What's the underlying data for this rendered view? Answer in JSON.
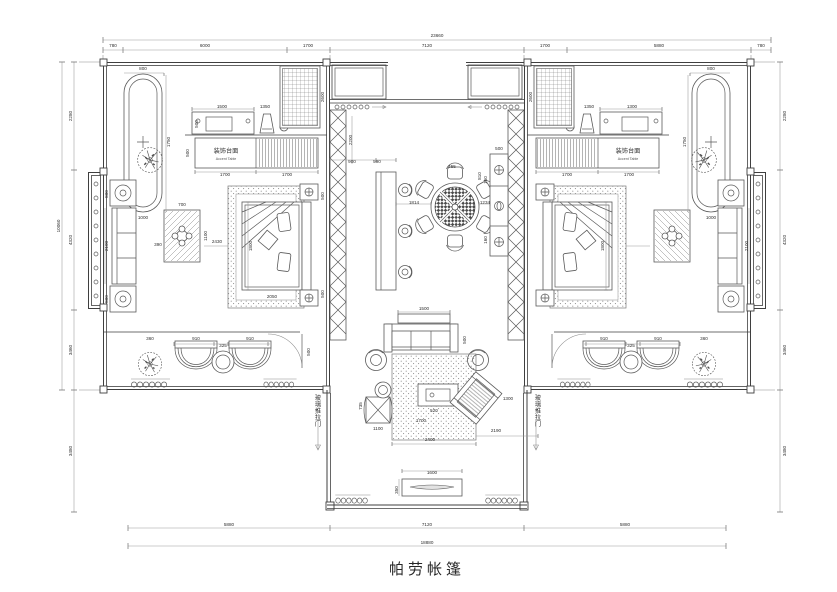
{
  "title": {
    "text": "帕劳帐篷"
  },
  "colors": {
    "line": "#3f3f3f",
    "furniture": "#5a5a5a",
    "dim": "#9a9a9a",
    "background": "#ffffff",
    "text": "#2f2f2f"
  },
  "rooms": {
    "accent_table_cn": "装饰台面",
    "accent_table_en": "Accent Table",
    "sliding_door_note": "玻璃推拉门"
  },
  "dimensions": {
    "top_total": "23660",
    "top_segments": [
      "780",
      "6000",
      "1700",
      "7120",
      "1700",
      "5880",
      "780"
    ],
    "bottom_segments": [
      "5880",
      "7120",
      "5880"
    ],
    "bottom_total": "18880",
    "left_segments": [
      "2280",
      "4320",
      "3460"
    ],
    "left_total": "10060",
    "left_lower": "3480",
    "right_segments": [
      "2280",
      "4320",
      "3460"
    ],
    "right_lower": "3480"
  },
  "annotations": {
    "labels": [
      {
        "t": "23660",
        "x": 437,
        "y": 37
      },
      {
        "t": "780",
        "x": 113,
        "y": 47
      },
      {
        "t": "6000",
        "x": 205,
        "y": 47
      },
      {
        "t": "1700",
        "x": 308,
        "y": 47
      },
      {
        "t": "7120",
        "x": 427,
        "y": 47
      },
      {
        "t": "1700",
        "x": 545,
        "y": 47
      },
      {
        "t": "5880",
        "x": 659,
        "y": 47
      },
      {
        "t": "780",
        "x": 761,
        "y": 47
      },
      {
        "t": "5880",
        "x": 229,
        "y": 526
      },
      {
        "t": "7120",
        "x": 427,
        "y": 526
      },
      {
        "t": "5880",
        "x": 625,
        "y": 526
      },
      {
        "t": "18880",
        "x": 427,
        "y": 544
      },
      {
        "t": "2280",
        "x": 72,
        "y": 116,
        "r": -90
      },
      {
        "t": "4320",
        "x": 72,
        "y": 240,
        "r": -90
      },
      {
        "t": "3460",
        "x": 72,
        "y": 350,
        "r": -90
      },
      {
        "t": "10060",
        "x": 60,
        "y": 226,
        "r": -90
      },
      {
        "t": "3480",
        "x": 72,
        "y": 451,
        "r": -90
      },
      {
        "t": "2280",
        "x": 786,
        "y": 116,
        "r": -90
      },
      {
        "t": "4320",
        "x": 786,
        "y": 240,
        "r": -90
      },
      {
        "t": "3460",
        "x": 786,
        "y": 350,
        "r": -90
      },
      {
        "t": "3480",
        "x": 786,
        "y": 451,
        "r": -90
      },
      {
        "t": "800",
        "x": 143,
        "y": 70
      },
      {
        "t": "1750",
        "x": 170,
        "y": 142,
        "r": -90
      },
      {
        "t": "1000",
        "x": 143,
        "y": 219
      },
      {
        "t": "1500",
        "x": 222,
        "y": 108
      },
      {
        "t": "500",
        "x": 198,
        "y": 124,
        "r": -90
      },
      {
        "t": "1350",
        "x": 265,
        "y": 108
      },
      {
        "t": "2600",
        "x": 324,
        "y": 97,
        "r": -90
      },
      {
        "t": "装饰台面",
        "x": 226,
        "y": 153,
        "c": "room"
      },
      {
        "t": "Accent Table",
        "x": 226,
        "y": 160,
        "c": "sub"
      },
      {
        "t": "1700",
        "x": 225,
        "y": 176
      },
      {
        "t": "1700",
        "x": 287,
        "y": 176
      },
      {
        "t": "500",
        "x": 189,
        "y": 153,
        "r": -90
      },
      {
        "t": "800",
        "x": 108,
        "y": 194,
        "r": -90
      },
      {
        "t": "2100",
        "x": 108,
        "y": 246,
        "r": -90
      },
      {
        "t": "800",
        "x": 108,
        "y": 299,
        "r": -90
      },
      {
        "t": "700",
        "x": 182,
        "y": 206
      },
      {
        "t": "1100",
        "x": 207,
        "y": 236,
        "r": -90
      },
      {
        "t": "390",
        "x": 158,
        "y": 246
      },
      {
        "t": "2430",
        "x": 217,
        "y": 243
      },
      {
        "t": "1800",
        "x": 252,
        "y": 246,
        "r": -90
      },
      {
        "t": "2050",
        "x": 272,
        "y": 298
      },
      {
        "t": "500",
        "x": 324,
        "y": 196,
        "r": -90
      },
      {
        "t": "500",
        "x": 324,
        "y": 294,
        "r": -90
      },
      {
        "t": "360",
        "x": 150,
        "y": 340
      },
      {
        "t": "910",
        "x": 196,
        "y": 340
      },
      {
        "t": "325",
        "x": 223,
        "y": 347
      },
      {
        "t": "910",
        "x": 250,
        "y": 340
      },
      {
        "t": "500",
        "x": 310,
        "y": 352,
        "r": -90
      },
      {
        "t": "玻璃推拉门",
        "x": 318,
        "y": 400,
        "s": 1,
        "c": "room"
      },
      {
        "t": "玻璃推拉门",
        "x": 538,
        "y": 400,
        "s": 1,
        "c": "room"
      },
      {
        "t": "900",
        "x": 352,
        "y": 163
      },
      {
        "t": "590",
        "x": 377,
        "y": 163
      },
      {
        "t": "2200",
        "x": 352,
        "y": 140,
        "r": -90
      },
      {
        "t": "1814",
        "x": 414,
        "y": 204
      },
      {
        "t": "455",
        "x": 452,
        "y": 168
      },
      {
        "t": "810",
        "x": 481,
        "y": 176,
        "r": -90
      },
      {
        "t": "1234",
        "x": 485,
        "y": 204
      },
      {
        "t": "500",
        "x": 499,
        "y": 150
      },
      {
        "t": "160",
        "x": 487,
        "y": 180,
        "r": -90
      },
      {
        "t": "160",
        "x": 487,
        "y": 240,
        "r": -90
      },
      {
        "t": "1500",
        "x": 424,
        "y": 310
      },
      {
        "t": "500",
        "x": 466,
        "y": 340,
        "r": -90
      },
      {
        "t": "735",
        "x": 362,
        "y": 406,
        "r": -90
      },
      {
        "t": "1100",
        "x": 378,
        "y": 430
      },
      {
        "t": "520",
        "x": 434,
        "y": 412
      },
      {
        "t": "1700",
        "x": 421,
        "y": 422
      },
      {
        "t": "2400",
        "x": 430,
        "y": 441
      },
      {
        "t": "2190",
        "x": 496,
        "y": 432
      },
      {
        "t": "1300",
        "x": 508,
        "y": 400
      },
      {
        "t": "1600",
        "x": 432,
        "y": 474
      },
      {
        "t": "350",
        "x": 398,
        "y": 490,
        "r": -90
      },
      {
        "t": "800",
        "x": 711,
        "y": 70
      },
      {
        "t": "1750",
        "x": 686,
        "y": 142,
        "r": -90
      },
      {
        "t": "1000",
        "x": 711,
        "y": 219
      },
      {
        "t": "1300",
        "x": 632,
        "y": 108
      },
      {
        "t": "1350",
        "x": 589,
        "y": 108
      },
      {
        "t": "2600",
        "x": 532,
        "y": 97,
        "r": -90
      },
      {
        "t": "装饰台面",
        "x": 628,
        "y": 153,
        "c": "room"
      },
      {
        "t": "Accent Table",
        "x": 628,
        "y": 160,
        "c": "sub"
      },
      {
        "t": "1700",
        "x": 629,
        "y": 176
      },
      {
        "t": "1700",
        "x": 567,
        "y": 176
      },
      {
        "t": "2100",
        "x": 748,
        "y": 246,
        "r": -90
      },
      {
        "t": "1800",
        "x": 604,
        "y": 246,
        "r": -90
      },
      {
        "t": "910",
        "x": 658,
        "y": 340
      },
      {
        "t": "325",
        "x": 631,
        "y": 347
      },
      {
        "t": "910",
        "x": 604,
        "y": 340
      },
      {
        "t": "360",
        "x": 704,
        "y": 340
      }
    ]
  }
}
